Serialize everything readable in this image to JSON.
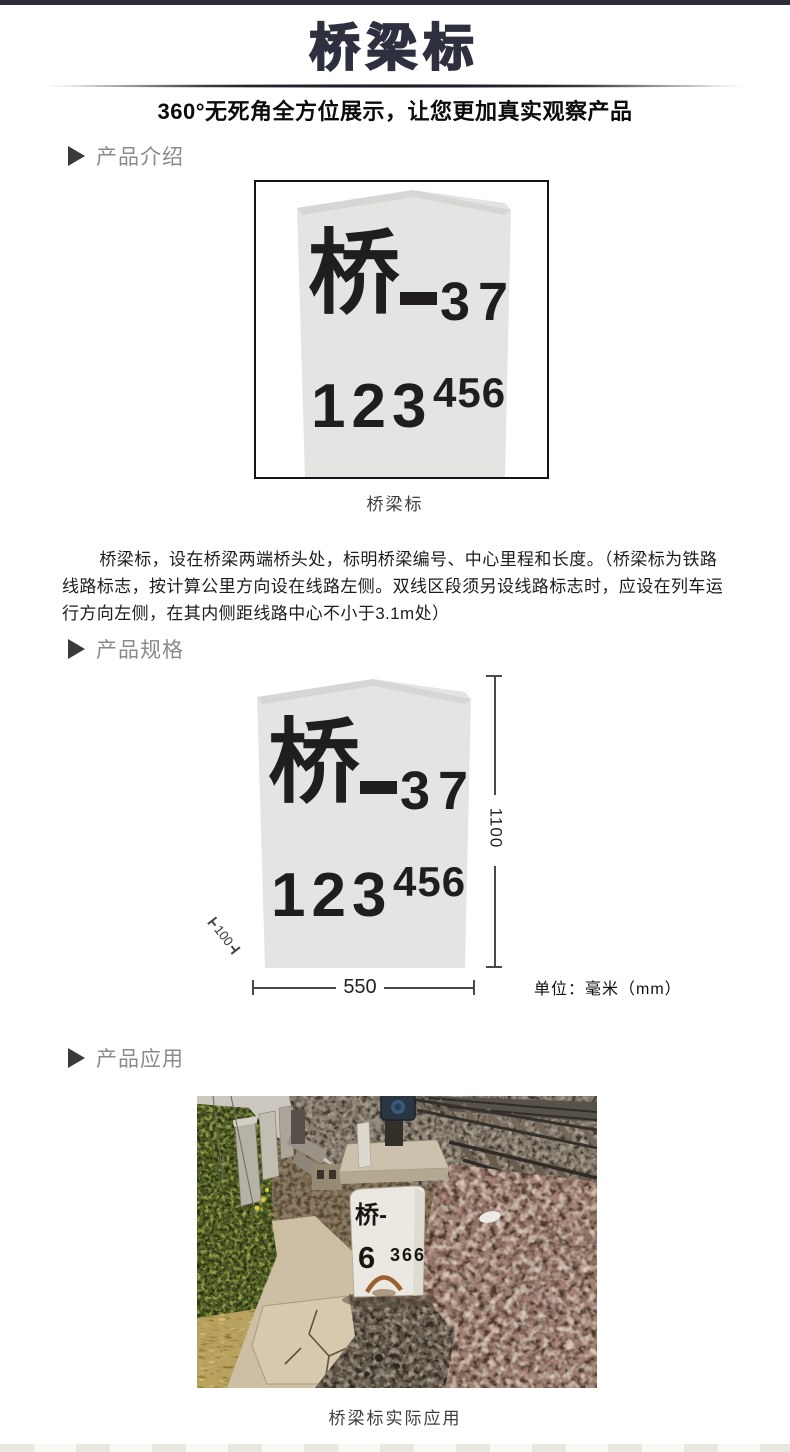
{
  "header": {
    "title": "桥梁标",
    "subtitle": "360°无死角全方位展示，让您更加真实观察产品"
  },
  "sections": [
    {
      "label": "产品介绍"
    },
    {
      "label": "产品规格"
    },
    {
      "label": "产品应用"
    }
  ],
  "marker_sign": {
    "char": "桥",
    "dash": "—",
    "serial": "37",
    "row2_main": "123",
    "row2_sup": "456"
  },
  "intro": {
    "caption": "桥梁标",
    "description": "桥梁标，设在桥梁两端桥头处，标明桥梁编号、中心里程和长度。（桥梁标为铁路线路标志，按计算公里方向设在线路左侧。双线区段须另设线路标志时，应设在列车运行方向左侧，在其内侧距线路中心不小于3.1m处）"
  },
  "specs": {
    "height_mm": "1100",
    "width_mm": "550",
    "side_mm": "100",
    "unit": "单位：毫米（mm）"
  },
  "application": {
    "stone_line1": "桥-",
    "stone_digit": "6",
    "stone_digits_small": "366",
    "caption": "桥梁标实际应用"
  },
  "colors": {
    "top_bar": "#2b2d38",
    "title": "#2e3040",
    "section_label": "#8a8a8a",
    "stone_fill": "#e4e4e2",
    "ballast": "#a28172",
    "vegetation": "#5a6631"
  }
}
